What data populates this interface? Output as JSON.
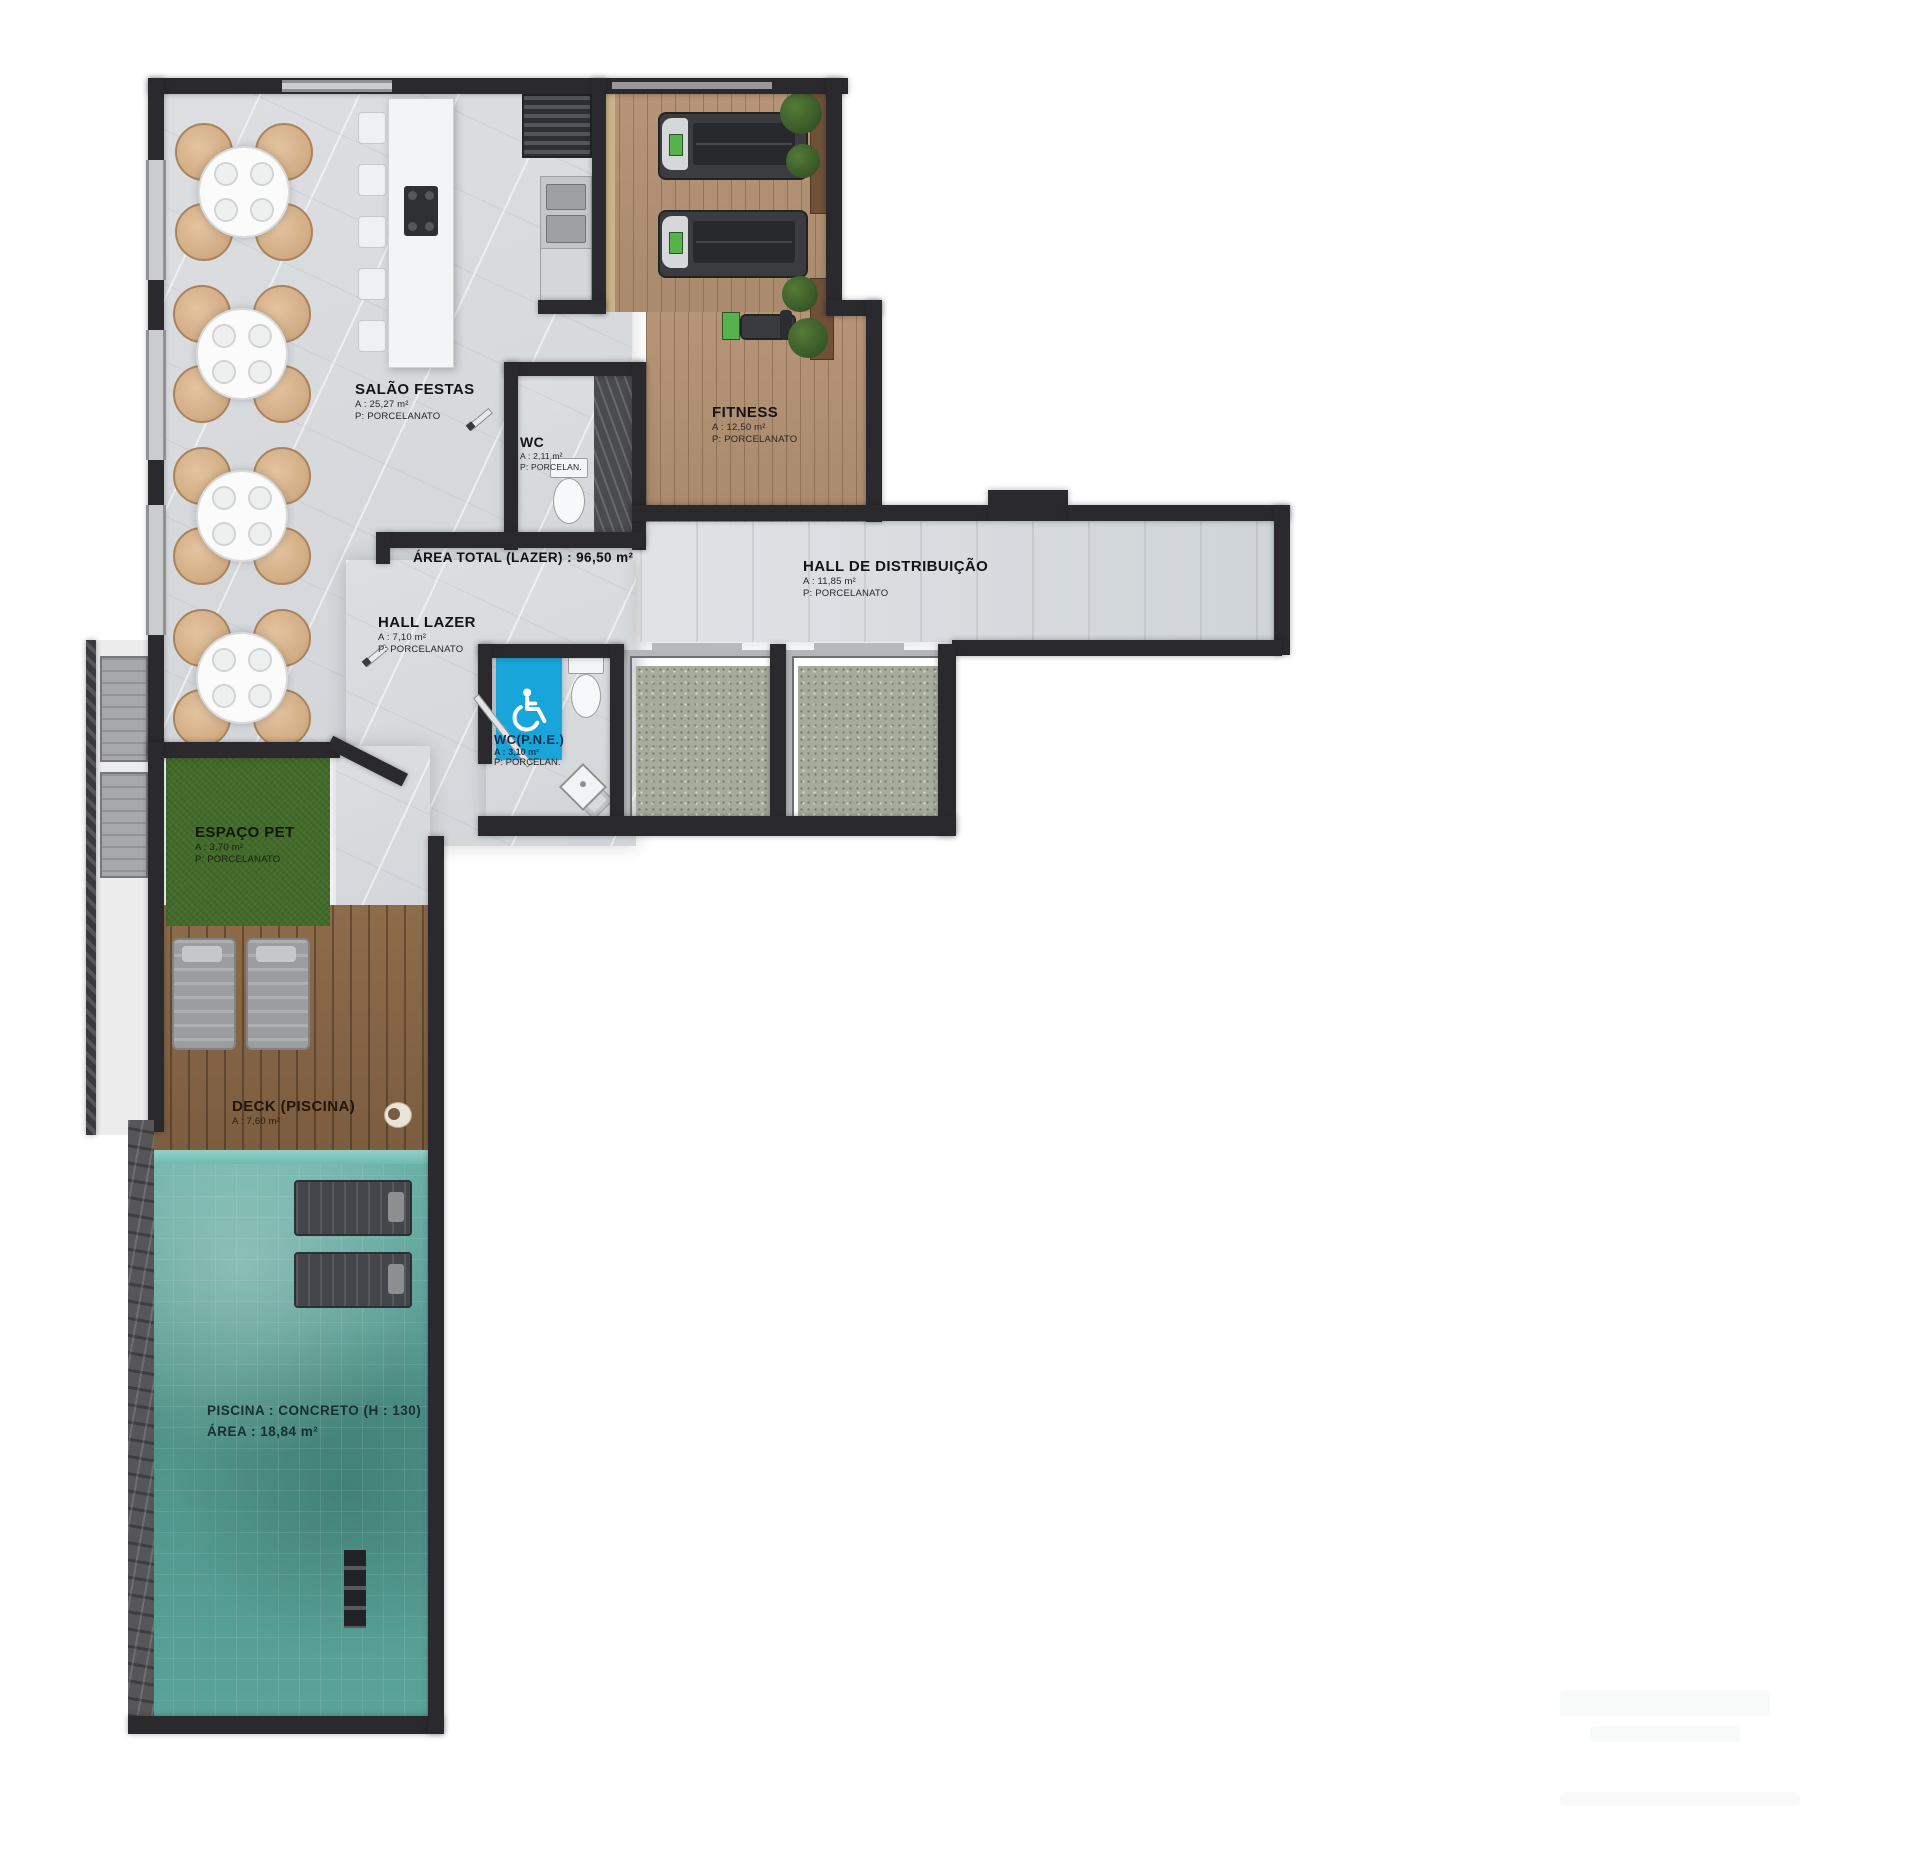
{
  "plan": {
    "title": "Pavimento lazer — planta humanizada",
    "annotations": {
      "area_total": "ÁREA TOTAL (LAZER) : 96,50 m²"
    },
    "rooms": {
      "salao_festas": {
        "name": "SALÃO FESTAS",
        "area": "A : 25,27 m²",
        "floor": "P: PORCELANATO"
      },
      "wc": {
        "name": "WC",
        "area": "A : 2,11 m²",
        "floor": "P: PORCELAN."
      },
      "fitness": {
        "name": "FITNESS",
        "area": "A : 12,50 m²",
        "floor": "P: PORCELANATO"
      },
      "hall_distribuicao": {
        "name": "HALL DE DISTRIBUIÇÃO",
        "area": "A : 11,85 m²",
        "floor": "P: PORCELANATO"
      },
      "hall_lazer": {
        "name": "HALL LAZER",
        "area": "A : 7,10 m²",
        "floor": "P: PORCELANATO"
      },
      "wc_pne": {
        "name": "WC(P.N.E.)",
        "area": "A : 3,10 m²",
        "floor": "P: PORCELAN."
      },
      "espaco_pet": {
        "name": "ESPAÇO PET",
        "area": "A : 3,70 m²",
        "floor": "P: PORCELANATO"
      },
      "deck_piscina": {
        "name": "DECK (PISCINA)",
        "area": "A : 7,60 m²"
      },
      "piscina": {
        "line1": "PISCINA : CONCRETO (H : 130)",
        "line2": "ÁREA : 18,84 m²"
      }
    },
    "icons": {
      "wheelchair": "accessible-wc"
    },
    "colors": {
      "wall": "#2A2A2E",
      "marble": "#D9DBDE",
      "accessible_blue": "#18A6DA",
      "pool_water": "#55A69B",
      "deck_wood": "#8A6847",
      "fitness_wood": "#B29274",
      "grass": "#436B2A",
      "granite": "#A6AB9C",
      "chair_beige": "#D8B48F"
    }
  }
}
